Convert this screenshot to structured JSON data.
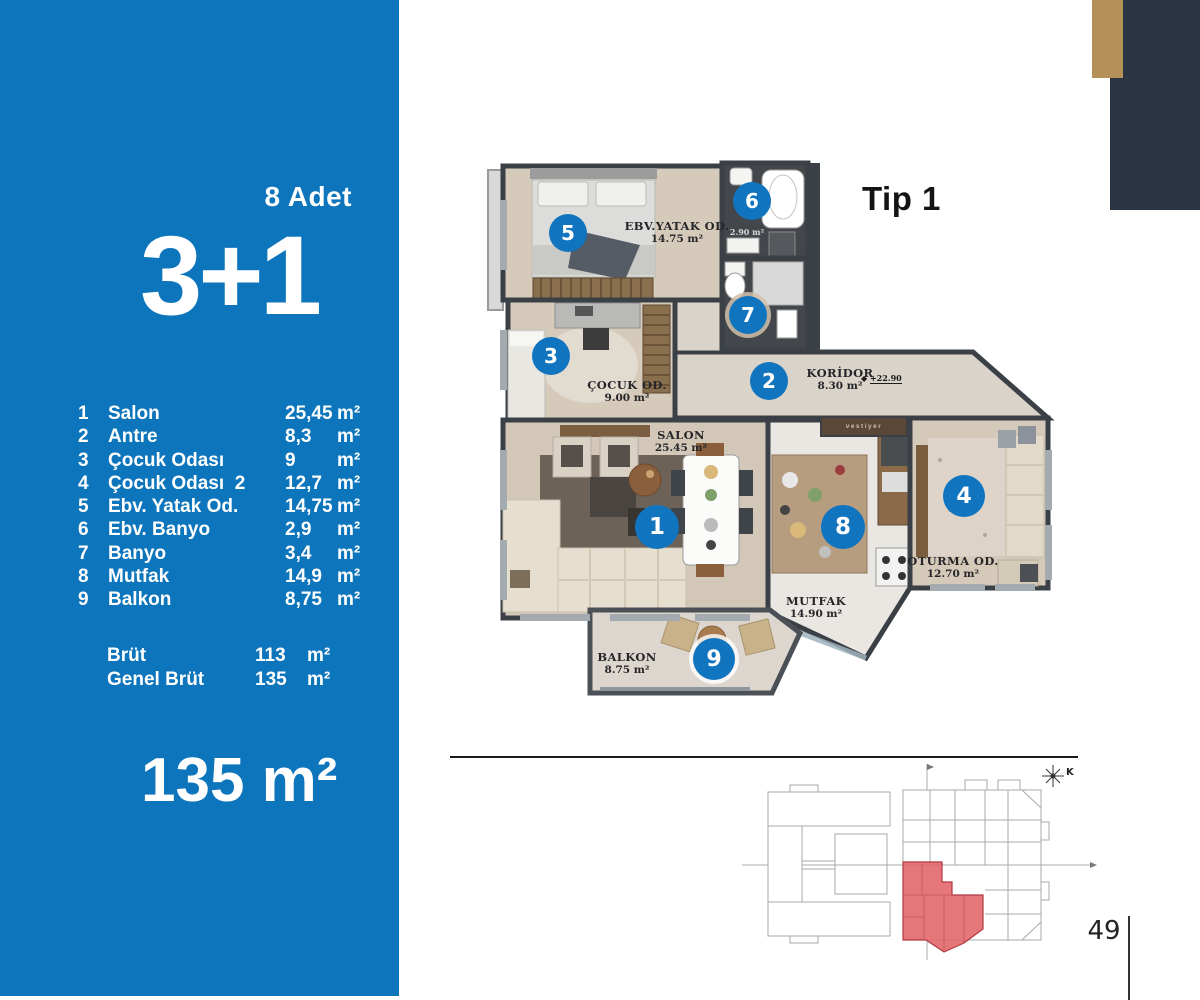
{
  "panel": {
    "count_label": "8 Adet",
    "type_label": "3+1",
    "rooms": [
      {
        "no": "1",
        "name": "Salon",
        "value": "25,45",
        "unit": "m²"
      },
      {
        "no": "2",
        "name": "Antre",
        "value": "8,3",
        "unit": "m²"
      },
      {
        "no": "3",
        "name": "Çocuk Odası",
        "value": "9",
        "unit": "m²"
      },
      {
        "no": "4",
        "name": "Çocuk Odası  2",
        "value": "12,7",
        "unit": "m²"
      },
      {
        "no": "5",
        "name": "Ebv. Yatak Od.",
        "value": "14,75",
        "unit": "m²"
      },
      {
        "no": "6",
        "name": "Ebv. Banyo",
        "value": "2,9",
        "unit": "m²"
      },
      {
        "no": "7",
        "name": "Banyo",
        "value": "3,4",
        "unit": "m²"
      },
      {
        "no": "8",
        "name": "Mutfak",
        "value": "14,9",
        "unit": "m²"
      },
      {
        "no": "9",
        "name": "Balkon",
        "value": "8,75",
        "unit": "m²"
      }
    ],
    "totals": [
      {
        "label": "Brüt",
        "value": "113",
        "unit": "m²"
      },
      {
        "label": "Genel Brüt",
        "value": "135",
        "unit": "m²"
      }
    ],
    "area_label": "135 m²"
  },
  "plan": {
    "title": "Tip 1",
    "markers": [
      "1",
      "2",
      "3",
      "4",
      "5",
      "6",
      "7",
      "8",
      "9"
    ],
    "rooms": {
      "salon": {
        "label": "SALON",
        "area": "25.45 m²"
      },
      "koridor": {
        "label": "KORİDOR",
        "area": "8.30 m²"
      },
      "cocuk": {
        "label": "ÇOCUK OD.",
        "area": "9.00 m²"
      },
      "oturma": {
        "label": "OTURMA OD.",
        "area": "12.70 m²"
      },
      "ebv_yatak": {
        "label": "EBV.YATAK OD.",
        "area": "14.75 m²"
      },
      "ebv_banyo": {
        "area": "2.90 m²"
      },
      "mutfak": {
        "label": "MUTFAK",
        "area": "14.90 m²"
      },
      "balkon": {
        "label": "BALKON",
        "area": "8.75 m²"
      }
    },
    "elevation": "+22.90",
    "closet_label": "vestiyer",
    "compass_label": "K"
  },
  "page": {
    "number": "49"
  },
  "colors": {
    "panel_blue": "#0c75bb",
    "marker_blue": "#1174bf",
    "navy": "#2b3442",
    "tan": "#b5915a",
    "wall": "#3a4046",
    "highlight_red": "#e2686d"
  }
}
